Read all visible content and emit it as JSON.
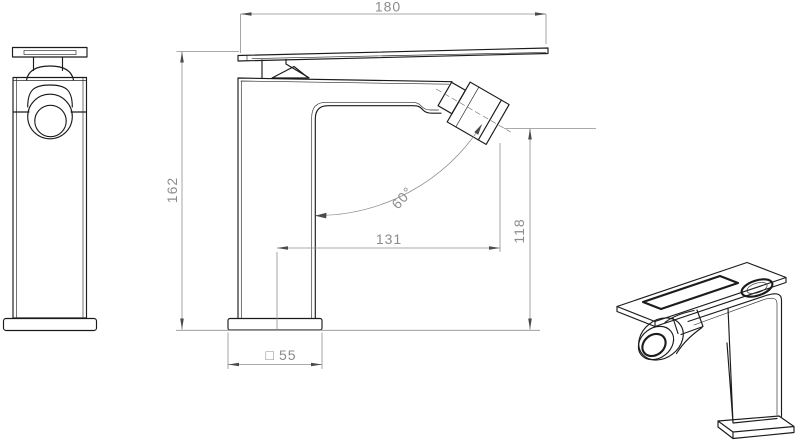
{
  "drawing": {
    "kind": "faucet-technical-drawing",
    "views": {
      "front": "front-view",
      "side": "side-view",
      "perspective": "perspective-view"
    },
    "colors": {
      "background": "#ffffff",
      "object_line": "#1b1b1b",
      "dimension_line": "#8f8f8f",
      "dimension_text": "#8c8c8c"
    },
    "dims": {
      "overall_width": {
        "value": "180"
      },
      "overall_height": {
        "value": "162"
      },
      "spout_reach": {
        "value": "131"
      },
      "outlet_height": {
        "value": "118"
      },
      "outlet_angle": {
        "value": "60°"
      },
      "base_size": {
        "symbol": "□",
        "value": "55"
      }
    }
  }
}
